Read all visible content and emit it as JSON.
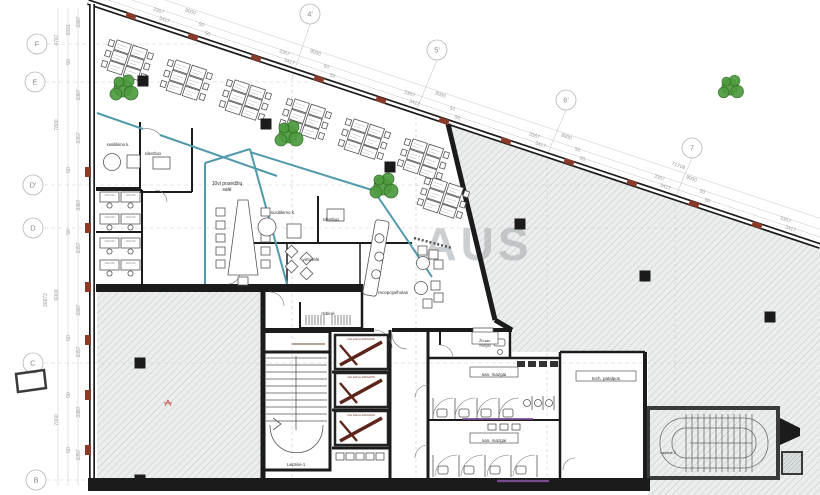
{
  "watermark": "AUS",
  "colors": {
    "wall": "#1b1b1b",
    "partition_teal": "#4f9aab",
    "pier_red": "#8a3a28",
    "purple": "#7a4b8f",
    "plant_green": "#4e9b3f",
    "plant_dark": "#2e6b22",
    "hatch_line": "#c2c6c7",
    "dim_gray": "#9a9a9a"
  },
  "rooms": {
    "lift_label": "Lifto kabina 2000x2000",
    "desk_label": "1400x700"
  },
  "plan": {
    "grid_bubbles": [
      {
        "t": "F",
        "x": 37,
        "y": 44
      },
      {
        "t": "E",
        "x": 35,
        "y": 82
      },
      {
        "t": "D'",
        "x": 33,
        "y": 185
      },
      {
        "t": "D",
        "x": 33,
        "y": 228
      },
      {
        "t": "C",
        "x": 33,
        "y": 363
      },
      {
        "t": "B",
        "x": 36,
        "y": 480
      },
      {
        "t": "4'",
        "x": 310,
        "y": 14
      },
      {
        "t": "5'",
        "x": 437,
        "y": 50
      },
      {
        "t": "6'",
        "x": 566,
        "y": 100
      },
      {
        "t": "7",
        "x": 692,
        "y": 148
      }
    ],
    "top_dims": [
      {
        "t": "3367",
        "x": 158,
        "y": 12
      },
      {
        "t": "3367",
        "x": 284,
        "y": 54
      },
      {
        "t": "3367",
        "x": 409,
        "y": 95
      },
      {
        "t": "3367",
        "x": 534,
        "y": 137
      },
      {
        "t": "3367",
        "x": 659,
        "y": 179
      },
      {
        "t": "3367",
        "x": 785,
        "y": 221
      },
      {
        "t": "3417",
        "x": 164,
        "y": 21
      },
      {
        "t": "3417",
        "x": 289,
        "y": 63
      },
      {
        "t": "3417",
        "x": 414,
        "y": 104
      },
      {
        "t": "3417",
        "x": 540,
        "y": 146
      },
      {
        "t": "3417",
        "x": 665,
        "y": 188
      },
      {
        "t": "3417",
        "x": 790,
        "y": 230
      },
      {
        "t": "50",
        "x": 201,
        "y": 26
      },
      {
        "t": "50",
        "x": 326,
        "y": 68
      },
      {
        "t": "50",
        "x": 452,
        "y": 110
      },
      {
        "t": "50",
        "x": 577,
        "y": 151
      },
      {
        "t": "50",
        "x": 702,
        "y": 193
      },
      {
        "t": "50",
        "x": 207,
        "y": 35
      },
      {
        "t": "50",
        "x": 332,
        "y": 77
      },
      {
        "t": "50",
        "x": 457,
        "y": 119
      },
      {
        "t": "50",
        "x": 582,
        "y": 160
      },
      {
        "t": "50",
        "x": 707,
        "y": 202
      },
      {
        "t": "8000",
        "x": 190,
        "y": 13
      },
      {
        "t": "8000",
        "x": 315,
        "y": 54
      },
      {
        "t": "8000",
        "x": 440,
        "y": 96
      },
      {
        "t": "8000",
        "x": 566,
        "y": 138
      },
      {
        "t": "8000",
        "x": 691,
        "y": 180
      },
      {
        "t": "71708",
        "x": 678,
        "y": 167
      }
    ],
    "left_dims": [
      {
        "t": "3387",
        "x": 80,
        "y": 22
      },
      {
        "t": "3331",
        "x": 70,
        "y": 30
      },
      {
        "t": "3387",
        "x": 80,
        "y": 95
      },
      {
        "t": "3357",
        "x": 80,
        "y": 138
      },
      {
        "t": "3387",
        "x": 80,
        "y": 205
      },
      {
        "t": "3357",
        "x": 80,
        "y": 248
      },
      {
        "t": "3387",
        "x": 80,
        "y": 310
      },
      {
        "t": "3357",
        "x": 80,
        "y": 352
      },
      {
        "t": "3387",
        "x": 80,
        "y": 412
      },
      {
        "t": "3357",
        "x": 80,
        "y": 455
      },
      {
        "t": "50",
        "x": 70,
        "y": 62
      },
      {
        "t": "50",
        "x": 70,
        "y": 170
      },
      {
        "t": "50",
        "x": 70,
        "y": 232
      },
      {
        "t": "50",
        "x": 70,
        "y": 338
      },
      {
        "t": "50",
        "x": 70,
        "y": 395
      },
      {
        "t": "50",
        "x": 70,
        "y": 450
      },
      {
        "t": "4787",
        "x": 58,
        "y": 40
      },
      {
        "t": "7800",
        "x": 58,
        "y": 125
      },
      {
        "t": "6000",
        "x": 58,
        "y": 295
      },
      {
        "t": "7000",
        "x": 58,
        "y": 420
      },
      {
        "t": "36872",
        "x": 47,
        "y": 300
      }
    ],
    "room_labels": [
      {
        "lines": [
          "10vi posėdžių",
          "salė"
        ],
        "x": 227,
        "y": 183,
        "size": 5
      },
      {
        "t": "susitikimo k.",
        "x": 118,
        "y": 144,
        "size": 4.2
      },
      {
        "t": "silentbox",
        "x": 153,
        "y": 153,
        "size": 4.2
      },
      {
        "t": "susitikimo k.",
        "x": 283,
        "y": 212,
        "size": 4.5
      },
      {
        "t": "silentbox",
        "x": 331,
        "y": 219,
        "size": 4.2
      },
      {
        "t": "virtuvėlė",
        "x": 311,
        "y": 259,
        "size": 4.5
      },
      {
        "t": "recepcija/holas",
        "x": 393,
        "y": 292,
        "size": 4.5
      },
      {
        "t": "rūbinė",
        "x": 328,
        "y": 313,
        "size": 4.8
      },
      {
        "t": "san. mazgai",
        "x": 494,
        "y": 374,
        "size": 4.5,
        "box": [
          48,
          10
        ]
      },
      {
        "t": "san. mazgai",
        "x": 494,
        "y": 440,
        "size": 4.5,
        "box": [
          48,
          10
        ]
      },
      {
        "lines": [
          "ŽN san.",
          "mazgas"
        ],
        "x": 485,
        "y": 340,
        "size": 3.4,
        "box": [
          26,
          12
        ]
      },
      {
        "t": "tech. patalpos",
        "x": 606,
        "y": 378,
        "size": 4.5,
        "box": [
          60,
          10
        ]
      },
      {
        "t": "Laiptinė-1",
        "x": 296,
        "y": 464,
        "size": 4.2
      },
      {
        "t": "Laiptinė-2",
        "x": 668,
        "y": 452,
        "size": 3.6
      }
    ],
    "lifts": [
      {
        "x": 333,
        "y": 333
      },
      {
        "x": 333,
        "y": 371
      },
      {
        "x": 333,
        "y": 409
      }
    ],
    "columns": [
      {
        "x": 143,
        "y": 81
      },
      {
        "x": 266,
        "y": 124
      },
      {
        "x": 390,
        "y": 167
      },
      {
        "x": 520,
        "y": 224
      },
      {
        "x": 645,
        "y": 276
      },
      {
        "x": 770,
        "y": 317
      },
      {
        "x": 140,
        "y": 363
      },
      {
        "x": 140,
        "y": 480
      }
    ],
    "piers_facade": [
      {
        "x": 131,
        "y": 16
      },
      {
        "x": 193,
        "y": 37
      },
      {
        "x": 256,
        "y": 58
      },
      {
        "x": 319,
        "y": 79
      },
      {
        "x": 381,
        "y": 100
      },
      {
        "x": 444,
        "y": 121
      },
      {
        "x": 506,
        "y": 141
      },
      {
        "x": 569,
        "y": 162
      },
      {
        "x": 632,
        "y": 183
      },
      {
        "x": 694,
        "y": 204
      },
      {
        "x": 757,
        "y": 225
      }
    ],
    "piers_left": [
      {
        "y": 172
      },
      {
        "y": 228
      },
      {
        "y": 287
      },
      {
        "y": 340
      },
      {
        "y": 395
      },
      {
        "y": 450
      }
    ],
    "plants": [
      {
        "x": 123,
        "y": 88,
        "s": 1
      },
      {
        "x": 288,
        "y": 134,
        "s": 1
      },
      {
        "x": 383,
        "y": 186,
        "s": 1
      },
      {
        "x": 730,
        "y": 87,
        "s": 0.9
      }
    ],
    "desk_clusters": [
      {
        "x": 127,
        "y": 61
      },
      {
        "x": 186,
        "y": 81
      },
      {
        "x": 245,
        "y": 101
      },
      {
        "x": 305,
        "y": 120
      },
      {
        "x": 364,
        "y": 140
      },
      {
        "x": 423,
        "y": 160
      },
      {
        "x": 443,
        "y": 199
      }
    ],
    "office_desks": [
      {
        "x": 100,
        "y": 192
      },
      {
        "x": 121,
        "y": 192
      },
      {
        "x": 100,
        "y": 214
      },
      {
        "x": 121,
        "y": 214
      },
      {
        "x": 100,
        "y": 238
      },
      {
        "x": 121,
        "y": 238
      },
      {
        "x": 100,
        "y": 260
      },
      {
        "x": 121,
        "y": 260
      }
    ],
    "red_marks": [
      {
        "x": 168,
        "y": 403
      }
    ]
  }
}
